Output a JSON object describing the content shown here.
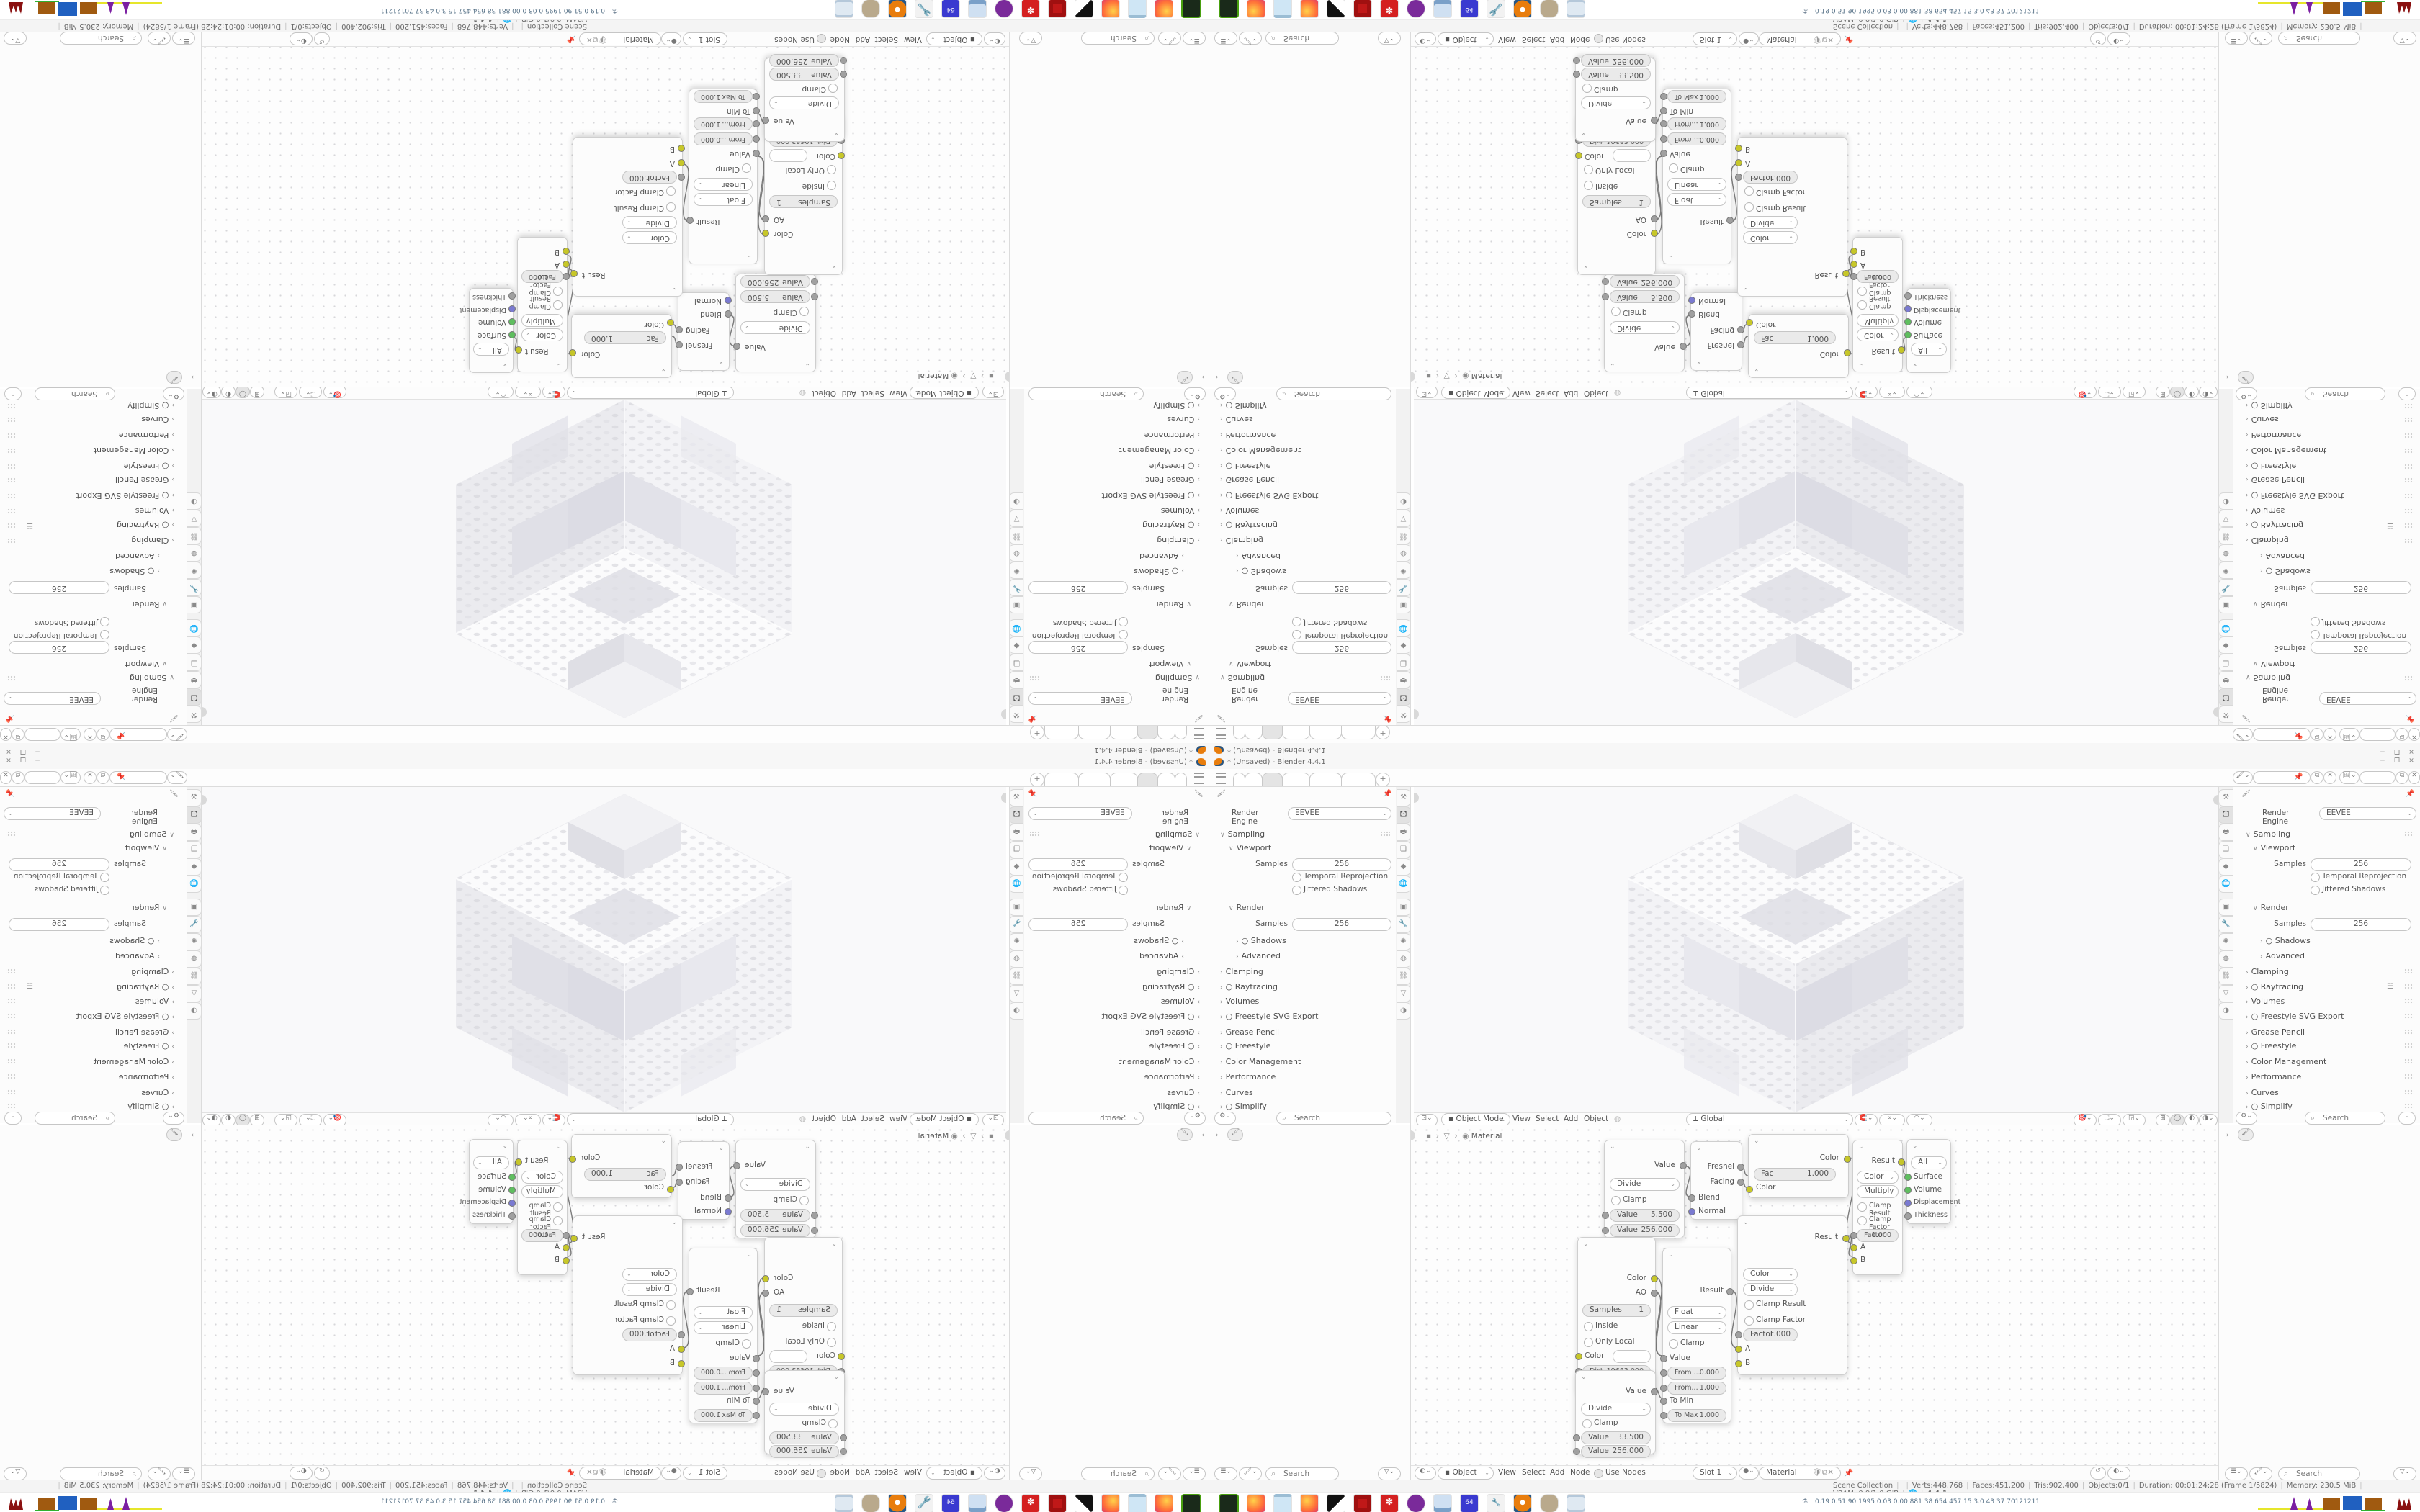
{
  "titlebar": {
    "title": "* (Unsaved) - Blender 4.4.1",
    "minimize": "─",
    "restore": "❐",
    "close": "✕",
    "plus_tab": "+"
  },
  "render_panel": {
    "engine_label": "Render Engine",
    "engine_value": "EEVEE",
    "sampling": "Sampling",
    "viewport": "Viewport",
    "samples_label": "Samples",
    "viewport_samples": "256",
    "temporal_reprojection": "Temporal Reprojection",
    "jittered_shadows": "Jittered Shadows",
    "render": "Render",
    "render_samples": "256",
    "shadows": "Shadows",
    "advanced": "Advanced",
    "clamping": "Clamping",
    "raytracing": "Raytracing",
    "volumes": "Volumes",
    "freestyle_svg": "Freestyle SVG Export",
    "grease_pencil": "Grease Pencil",
    "freestyle": "Freestyle",
    "color_management": "Color Management",
    "performance": "Performance",
    "curves": "Curves",
    "simplify": "Simplify",
    "search_placeholder": "Search"
  },
  "prop_tabs": [
    {
      "name": "tool",
      "glyph": "⚒"
    },
    {
      "name": "render",
      "glyph": "🖸"
    },
    {
      "name": "output",
      "glyph": "🖶"
    },
    {
      "name": "view-layer",
      "glyph": "❏"
    },
    {
      "name": "scene",
      "glyph": "◆"
    },
    {
      "name": "world",
      "glyph": "🌐"
    },
    {
      "name": "object",
      "glyph": "▣"
    },
    {
      "name": "modifiers",
      "glyph": "🔧"
    },
    {
      "name": "particles",
      "glyph": "✺"
    },
    {
      "name": "physics",
      "glyph": "◍"
    },
    {
      "name": "constraints",
      "glyph": "⛓"
    },
    {
      "name": "data",
      "glyph": "▽"
    },
    {
      "name": "material",
      "glyph": "◑"
    }
  ],
  "viewport_header": {
    "mode": "Object Mode",
    "menus": [
      "View",
      "Select",
      "Add",
      "Object"
    ],
    "orientation": "Global"
  },
  "node_editor": {
    "breadcrumb_material": "Material",
    "footer": {
      "object": "Object",
      "view": "View",
      "select": "Select",
      "add": "Add",
      "node": "Node",
      "use_nodes": "Use Nodes",
      "slot": "Slot 1",
      "material": "Material"
    }
  },
  "nodes": {
    "math1": {
      "out": "Value",
      "op": "Divide",
      "clamp": "Clamp",
      "v1l": "Value",
      "v1": "5.500",
      "v2l": "Value",
      "v2": "256.000"
    },
    "fresnel": {
      "o1": "Fresnel",
      "o2": "Facing",
      "i1": "Blend",
      "i2": "Normal"
    },
    "mixa": {
      "out": "Color",
      "facl": "Fac",
      "fac": "1.000",
      "in1": "Color"
    },
    "mixb": {
      "out": "Result",
      "dd1": "Color",
      "dd2": "Multiply",
      "c1": "Clamp Result",
      "c2": "Clamp Factor",
      "fl": "Factor",
      "fv": "1.000",
      "a": "A",
      "b": "B"
    },
    "output": {
      "dd": "All",
      "i1": "Surface",
      "i2": "Volume",
      "i3": "Displacement",
      "i4": "Thickness"
    },
    "ao": {
      "o1": "Color",
      "o2": "AO",
      "sl": "Samples",
      "sv": "1",
      "c1": "Inside",
      "c2": "Only Local",
      "i1": "Color",
      "distl": "Dist...",
      "dist": "19683.000",
      "i2": "Normal"
    },
    "maprange": {
      "out": "Result",
      "dd1": "Float",
      "dd2": "Linear",
      "c1": "Clamp",
      "i1": "Value",
      "f1l": "From ...",
      "f1": "0.000",
      "f2l": "From...",
      "f2": "1.000",
      "tminl": "To Min",
      "tmaxl": "To Max",
      "tmax": "1.000"
    },
    "mixc": {
      "out": "Result",
      "dd1": "Color",
      "dd2": "Divide",
      "c1": "Clamp Result",
      "c2": "Clamp Factor",
      "fl": "Factor",
      "fv": "1.000",
      "a": "A",
      "b": "B"
    },
    "math2": {
      "out": "Value",
      "op": "Divide",
      "clamp": "Clamp",
      "v1l": "Value",
      "v1": "33.500",
      "v2l": "Value",
      "v2": "256.000"
    }
  },
  "status_bar": {
    "scene": "Scene Collection",
    "verts": "Verts:448,768",
    "faces": "Faces:451,200",
    "tris": "Tris:902,400",
    "objects": "Objects:0/1",
    "duration": "Duration: 00:01:24:28 (Frame 1/5824)",
    "memory": "Memory: 230.5 MiB",
    "vram": "VRAM: 0.9/1.0 GiB",
    "version": "4.4.1"
  },
  "taskbar": {
    "icons": [
      "terminal",
      "firefox",
      "notes",
      "firefox-2",
      "image-viewer",
      "settings-red",
      "gear-red",
      "privacy-mask",
      "display-settings",
      "floppy-64",
      "wrench-tool",
      "blender",
      "gimp",
      "document-scroll"
    ],
    "stats": "0.19 0.51   90   1995 0.03 0.00 881   38   654  457   15   3.0   43   37   70121211"
  },
  "colors": {
    "accent_orange": "#e87d0d",
    "socket_yellow": "#c7c729",
    "socket_green": "#5fbe5f",
    "socket_purple": "#7a7ad1",
    "socket_gray": "#a0a0a0"
  }
}
